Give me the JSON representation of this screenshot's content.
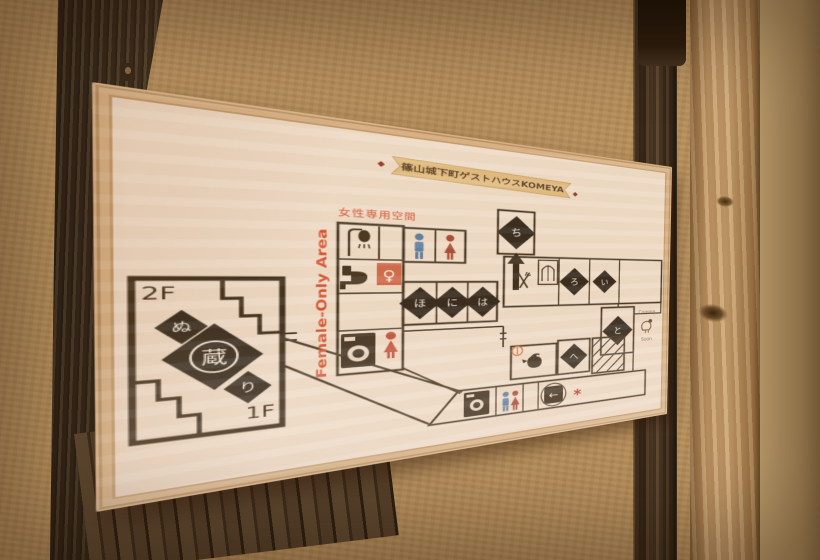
{
  "scene": {
    "wall_color": "#b68e5a",
    "left_post_color": "#54402a",
    "right_post_color": "#c79e6c",
    "rail_color": "#44311e",
    "slats_color": "#55402a"
  },
  "poster": {
    "frame_color": "#d8b286",
    "paper_color": "#eedac5",
    "ink_color": "#46331e",
    "title": "篠山城下町ゲストハウスKOMEYA",
    "banner_bg": "#e2bb7e",
    "legend": {
      "upper": "2F",
      "lower": "1F",
      "nu": "ぬ",
      "kura": "蔵",
      "ri": "り"
    },
    "female_area": {
      "ja": "女性専用空間",
      "en": "Female-Only Area",
      "accent": "#d2512e",
      "symbol": "♀"
    },
    "rooms": {
      "chi": "ち",
      "ro": "ろ",
      "i": "い",
      "ho": "ほ",
      "ni": "に",
      "ha": "は",
      "he": "へ",
      "to": "と"
    },
    "coming_soon": {
      "top": "Coming",
      "bottom": "Soon"
    },
    "entrance_arrow": "←",
    "star_marker": "*",
    "man_color": "#5d7d9c",
    "woman_color": "#a84a36",
    "diamond_fill": "#33271a"
  }
}
